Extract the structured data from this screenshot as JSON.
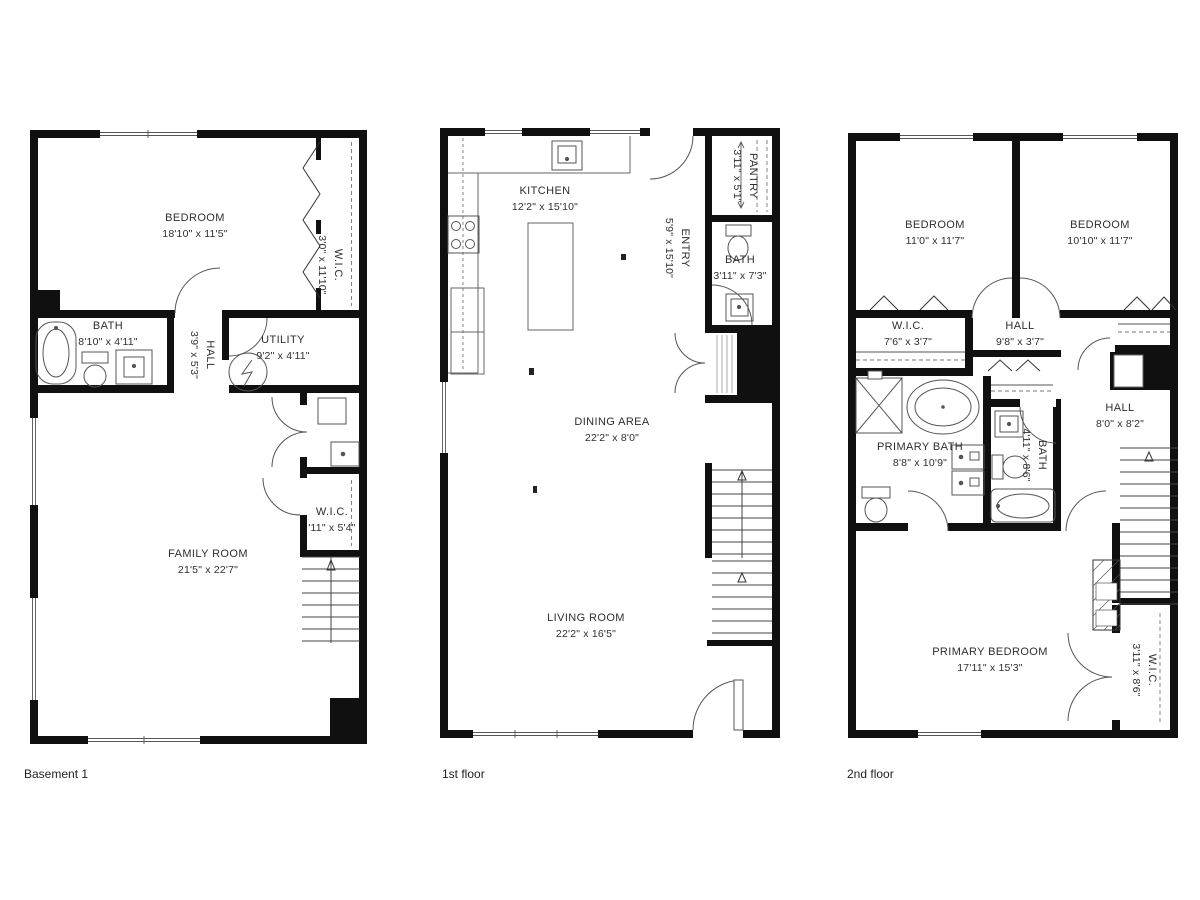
{
  "colors": {
    "wall": "#101010",
    "line": "#4a4a4a",
    "text": "#2e2e2e",
    "background": "#ffffff"
  },
  "floors": [
    {
      "label": "Basement 1",
      "rooms": [
        {
          "name": "BEDROOM",
          "dims": "18'10\" x 11'5\""
        },
        {
          "name": "W.I.C.",
          "dims": "3'0\" x 11'10\""
        },
        {
          "name": "BATH",
          "dims": "8'10\" x 4'11\""
        },
        {
          "name": "HALL",
          "dims": "3'9\" x 5'3\""
        },
        {
          "name": "UTILITY",
          "dims": "9'2\" x 4'11\""
        },
        {
          "name": "W.I.C.",
          "dims": "'11\" x 5'4\""
        },
        {
          "name": "FAMILY ROOM",
          "dims": "21'5\" x 22'7\""
        }
      ]
    },
    {
      "label": "1st floor",
      "rooms": [
        {
          "name": "KITCHEN",
          "dims": "12'2\" x 15'10\""
        },
        {
          "name": "PANTRY",
          "dims": "3'11\" x 5'1\""
        },
        {
          "name": "ENTRY",
          "dims": "5'9\" x 15'10\""
        },
        {
          "name": "BATH",
          "dims": "3'11\" x 7'3\""
        },
        {
          "name": "DINING AREA",
          "dims": "22'2\" x 8'0\""
        },
        {
          "name": "LIVING ROOM",
          "dims": "22'2\" x 16'5\""
        }
      ]
    },
    {
      "label": "2nd floor",
      "rooms": [
        {
          "name": "BEDROOM",
          "dims": "11'0\" x 11'7\""
        },
        {
          "name": "BEDROOM",
          "dims": "10'10\" x 11'7\""
        },
        {
          "name": "W.I.C.",
          "dims": "7'6\" x 3'7\""
        },
        {
          "name": "HALL",
          "dims": "9'8\" x 3'7\""
        },
        {
          "name": "PRIMARY BATH",
          "dims": "8'8\" x 10'9\""
        },
        {
          "name": "BATH",
          "dims": "4'11\" x 8'6\""
        },
        {
          "name": "HALL",
          "dims": "8'0\" x 8'2\""
        },
        {
          "name": "PRIMARY BEDROOM",
          "dims": "17'11\" x 15'3\""
        },
        {
          "name": "W.I.C.",
          "dims": "3'11\" x 8'6\""
        }
      ]
    }
  ]
}
